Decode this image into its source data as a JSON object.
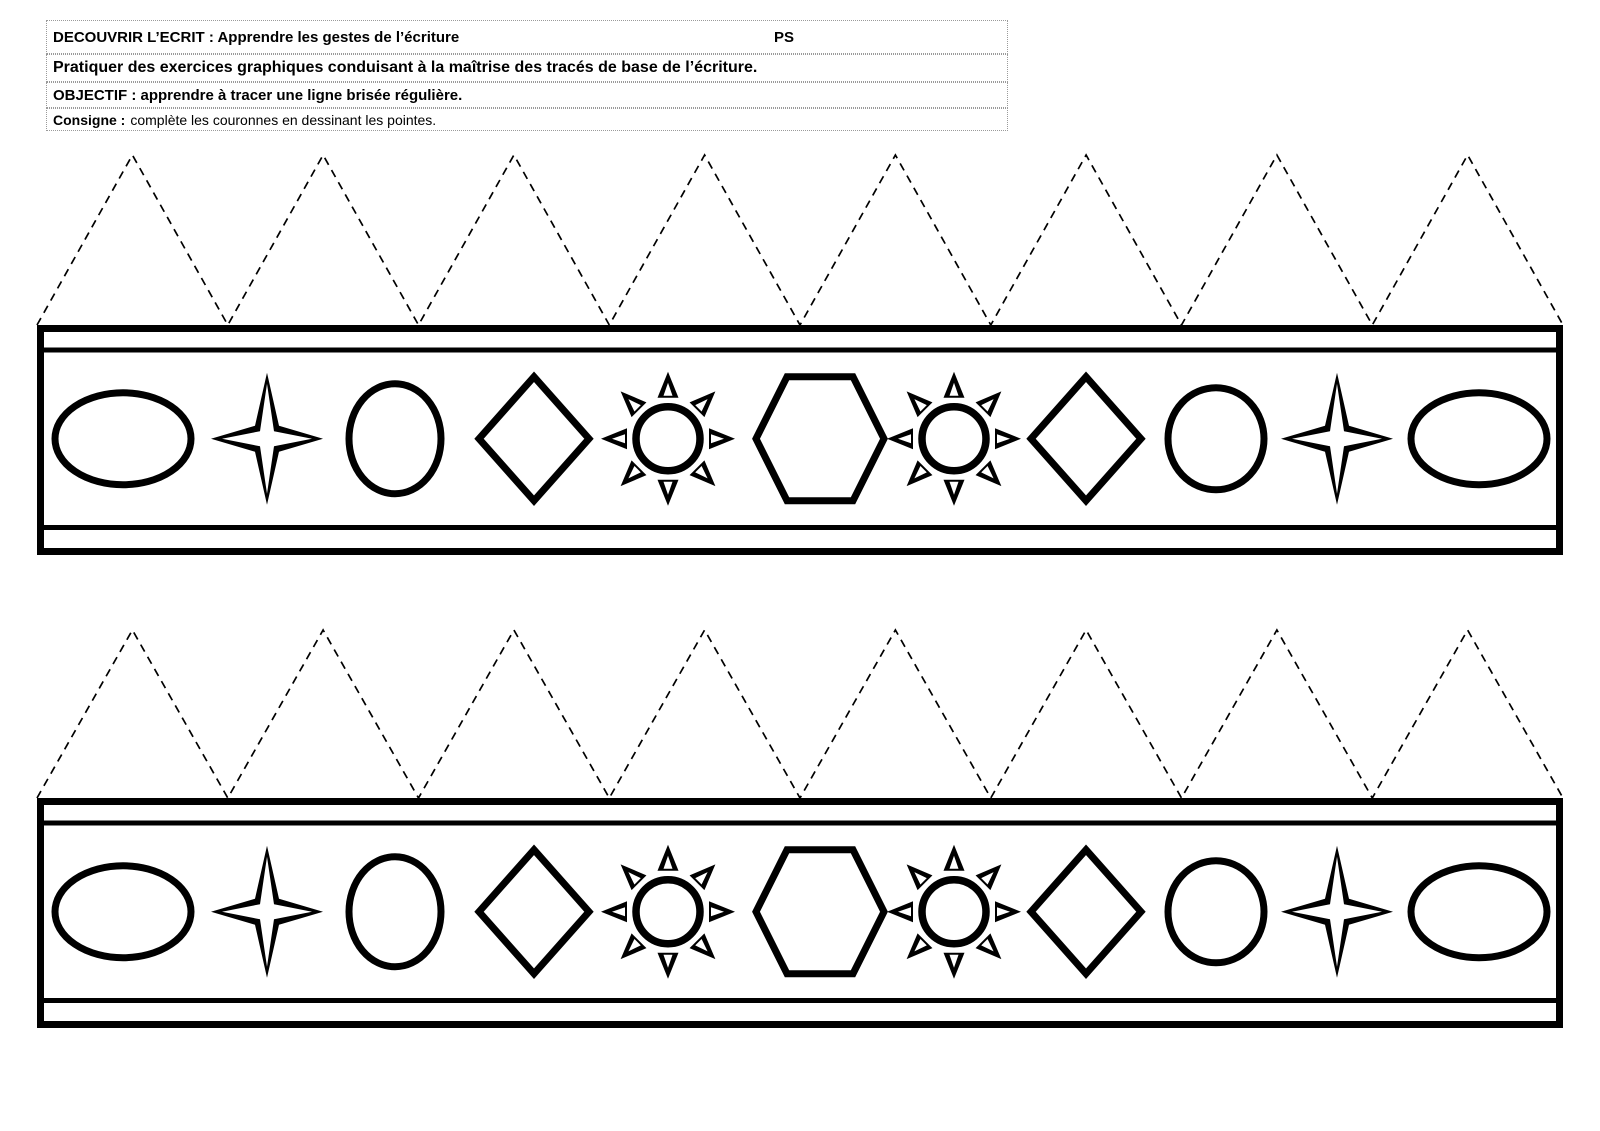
{
  "page": {
    "background": "#ffffff",
    "ink_color": "#000000",
    "guide_border_color": "#9a9a9a"
  },
  "header": {
    "domain_line": "DECOUVRIR L’ECRIT : Apprendre les gestes de l’écriture",
    "level": "PS",
    "competence_line": "Pratiquer des exercices graphiques conduisant à la maîtrise des tracés de base de l’écriture.",
    "objective_line": "OBJECTIF : apprendre à tracer une ligne brisée régulière.",
    "consigne_label": "Consigne :",
    "consigne_text": "complète les couronnes en dessinant les pointes."
  },
  "crown_figure": {
    "instances": 2,
    "points_per_crown": 8,
    "point_line_style": "dashed",
    "colors": {
      "ink": "#000000",
      "paper": "#ffffff"
    },
    "shape_sequence": [
      "oval-wide",
      "star-4point",
      "oval-tall",
      "diamond",
      "sun",
      "hexagon",
      "sun",
      "diamond",
      "circle",
      "star-4point",
      "oval-wide"
    ]
  }
}
